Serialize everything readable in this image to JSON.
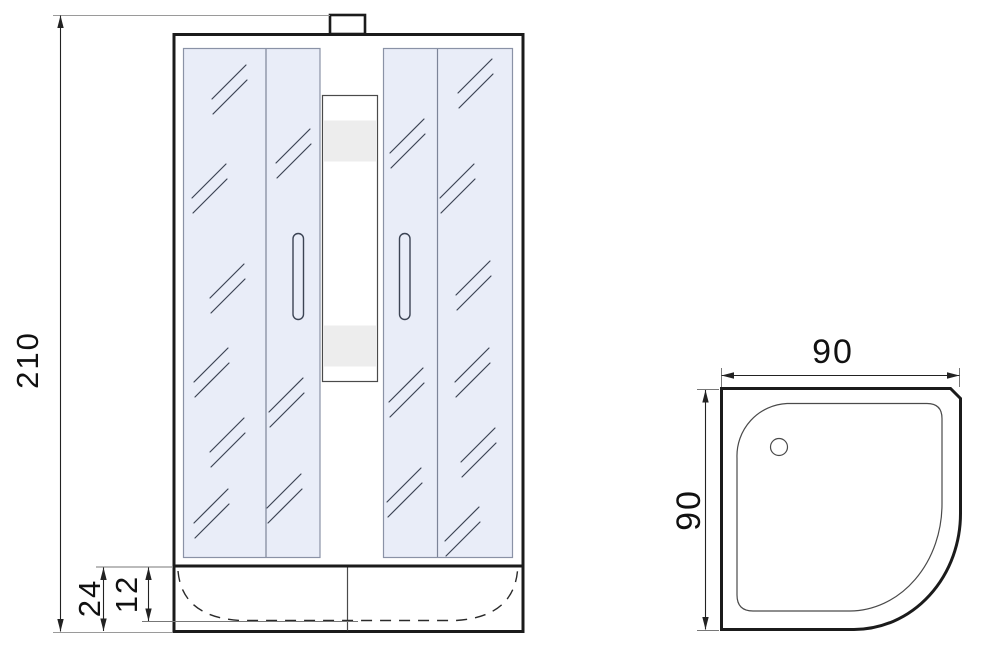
{
  "drawing": {
    "kind": "shower-cabin-technical-drawing",
    "front_view": {
      "dimensions": {
        "overall_height": "210",
        "tray_height": "24",
        "tray_inner_depth": "12"
      }
    },
    "top_view": {
      "dimensions": {
        "width": "90",
        "depth": "90"
      }
    }
  },
  "colors": {
    "background": "#ffffff",
    "line_heavy": "#1b1b1b",
    "line_thin": "#4a4a4a",
    "dimension_line": "#222222",
    "extension_line": "#9a9a9a",
    "glass_fill": "#e9edf8",
    "glass_stroke": "#8a92a6",
    "shelf_fill": "#ededed",
    "reflection_stroke": "#3c4454",
    "text": "#111111"
  }
}
